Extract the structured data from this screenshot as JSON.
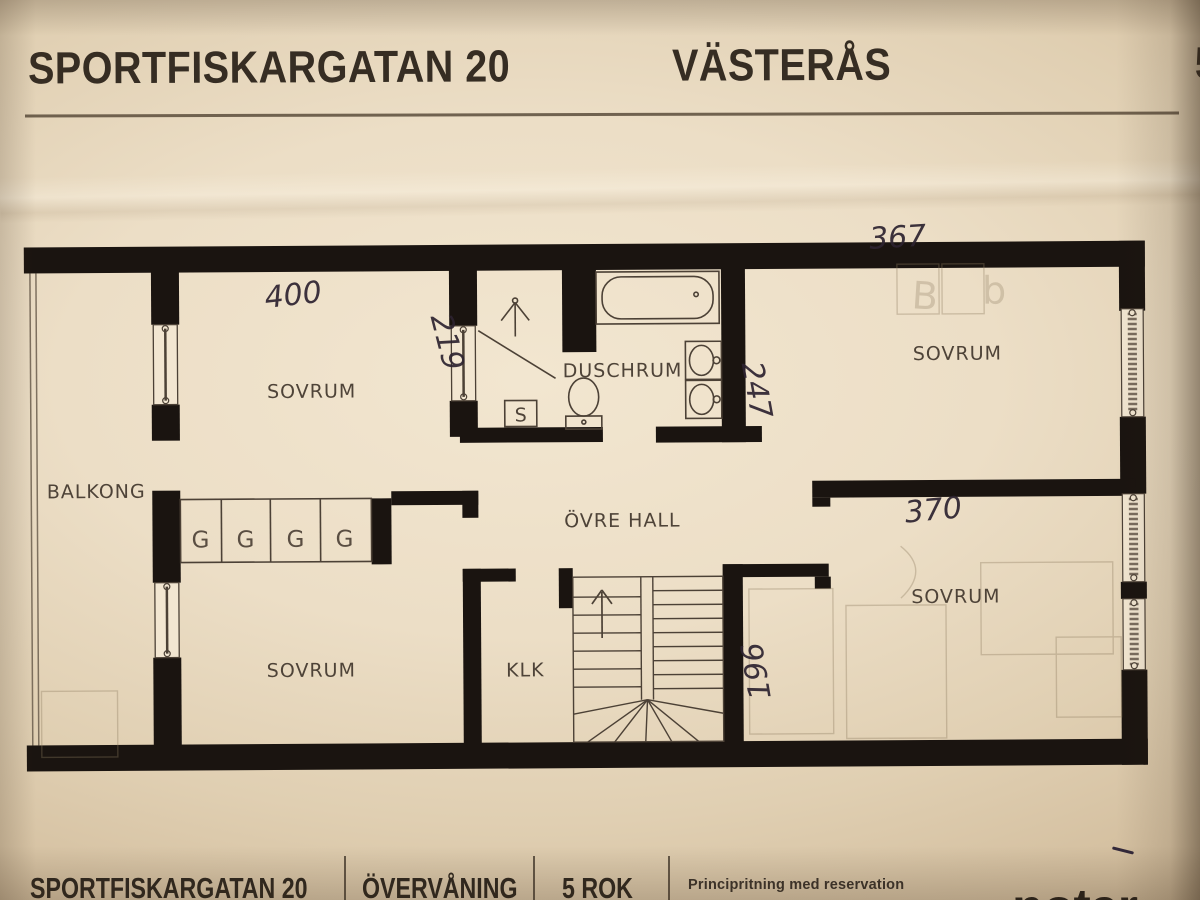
{
  "header": {
    "address": "SPORTFISKARGATAN 20",
    "city": "VÄSTERÅS",
    "rooms": "5 ROK"
  },
  "plan": {
    "labels": {
      "balcony": "BALKONG",
      "bedroom_top_left": "SOVRUM",
      "bedroom_bottom_left": "SOVRUM",
      "bedroom_top_right": "SOVRUM",
      "bedroom_bottom_right": "SOVRUM",
      "shower_room": "DUSCHRUM",
      "upper_hall": "ÖVRE HALL",
      "closet": "KLK",
      "cabinet": "S"
    },
    "wardrobes": [
      "G",
      "G",
      "G",
      "G"
    ],
    "measurements": {
      "bedroom_top_left_width": "400",
      "partition_left": "219",
      "bedroom_top_right_width": "367",
      "bedroom_top_right_depth": "247",
      "bedroom_bottom_right_width": "370",
      "stair_passage_width": "196"
    },
    "pencil_notes": [
      "B",
      "b"
    ]
  },
  "footer": {
    "address": "SPORTFISKARGATAN 20",
    "floor": "ÖVERVÅNING",
    "rooms": "5 ROK",
    "disclaimer": "Principritning med reservation",
    "logo": "notar"
  }
}
